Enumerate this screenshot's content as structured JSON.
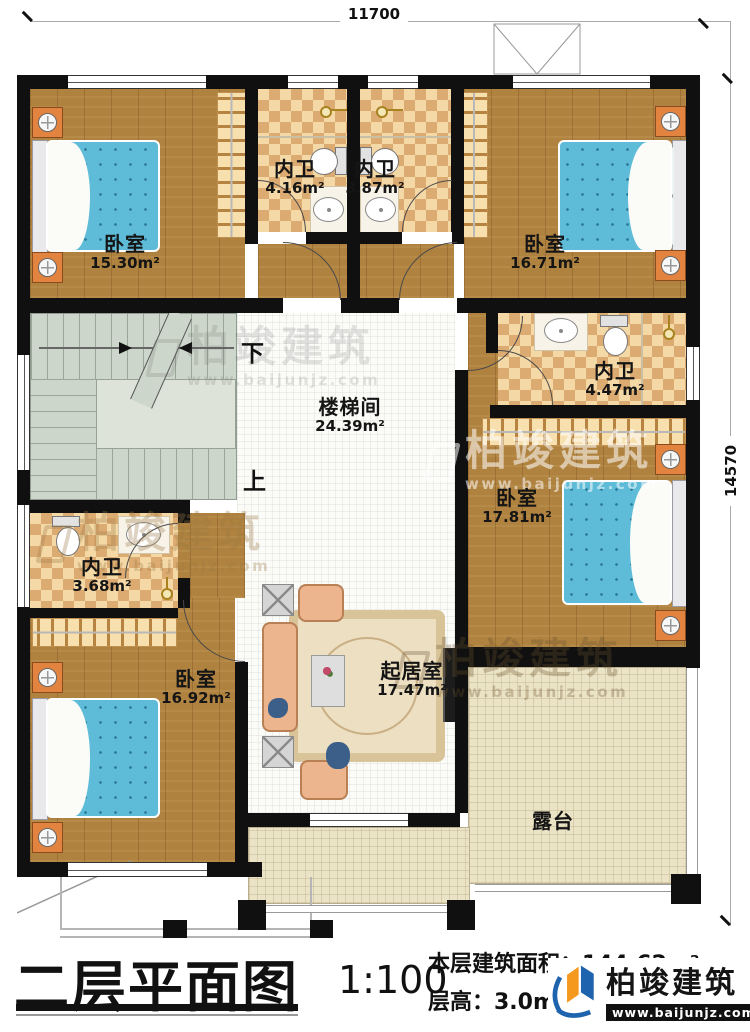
{
  "dims": {
    "top": "11700",
    "right": "14570"
  },
  "rooms": [
    {
      "id": "bedroom-top-left",
      "name": "卧室",
      "area": "15.30m²"
    },
    {
      "id": "bath-top-left",
      "name": "内卫",
      "area": "4.16m²"
    },
    {
      "id": "bath-top-mid",
      "name": "内卫",
      "area": "3.87m²"
    },
    {
      "id": "bedroom-top-right",
      "name": "卧室",
      "area": "16.71m²"
    },
    {
      "id": "stairwell",
      "name": "楼梯间",
      "area": "24.39m²"
    },
    {
      "id": "bath-mid-right",
      "name": "内卫",
      "area": "4.47m²"
    },
    {
      "id": "bedroom-mid-right",
      "name": "卧室",
      "area": "17.81m²"
    },
    {
      "id": "bath-bottom-left",
      "name": "内卫",
      "area": "3.68m²"
    },
    {
      "id": "bedroom-bottom-left",
      "name": "卧室",
      "area": "16.92m²"
    },
    {
      "id": "living-room",
      "name": "起居室",
      "area": "17.47m²"
    },
    {
      "id": "terrace",
      "name": "露台",
      "area": ""
    }
  ],
  "stair": {
    "down": "下",
    "up": "上"
  },
  "titleblock": {
    "title": "二层平面图",
    "scale": "1:100",
    "area_line": "本层建筑面积：144.62m²",
    "height_line": "层高：3.0m"
  },
  "brand": {
    "name": "柏竣建筑",
    "url": "www.baijunjz.com"
  },
  "colors": {
    "wall": "#101010",
    "wood": "#b0823f",
    "tile_light": "#f4d9a6",
    "tile_dark": "#dcab72",
    "bed": "#5fbcd9",
    "stair": "#ccd6ca",
    "terrace": "#ebe3c6",
    "living": "#fbfbf8",
    "nightstand": "#e2833f",
    "brand_blue": "#1e63ad",
    "brand_orange": "#f5991e"
  }
}
